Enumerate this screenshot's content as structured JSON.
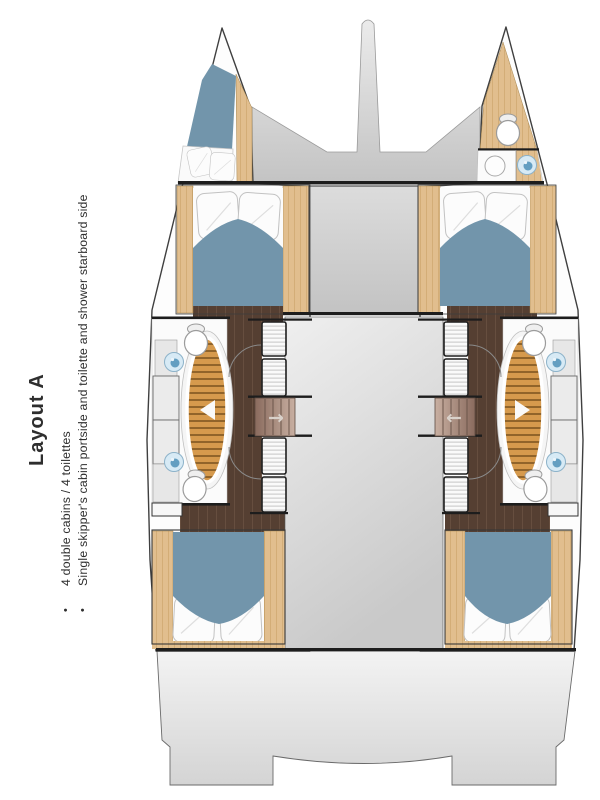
{
  "sidebar": {
    "title": "Layout A",
    "bullet_char": "•",
    "bullets": [
      "4 double cabins / 4 toilettes",
      "Single skipper's cabin portside and toilette and shower starboard side"
    ]
  },
  "plan": {
    "port_stairs_arrow": "→",
    "starboard_stairs_arrow": "←"
  },
  "colors": {
    "text": "#2e2e2e",
    "duvet_blue": "#7295ab",
    "wood_light": "#e1be8e",
    "wood_grain": "#c99f63",
    "teak": "#d69a4d",
    "teak_stripe": "#91642a",
    "floor_dark": "#553f32",
    "floor_grain": "#6d5344",
    "sink_blue": "#639ec1",
    "sink_pale": "#d7eaf5",
    "wall_black": "#1d1d1d",
    "hull_stroke": "#3f3f3f",
    "arrow_light": "#d9d1ca"
  }
}
